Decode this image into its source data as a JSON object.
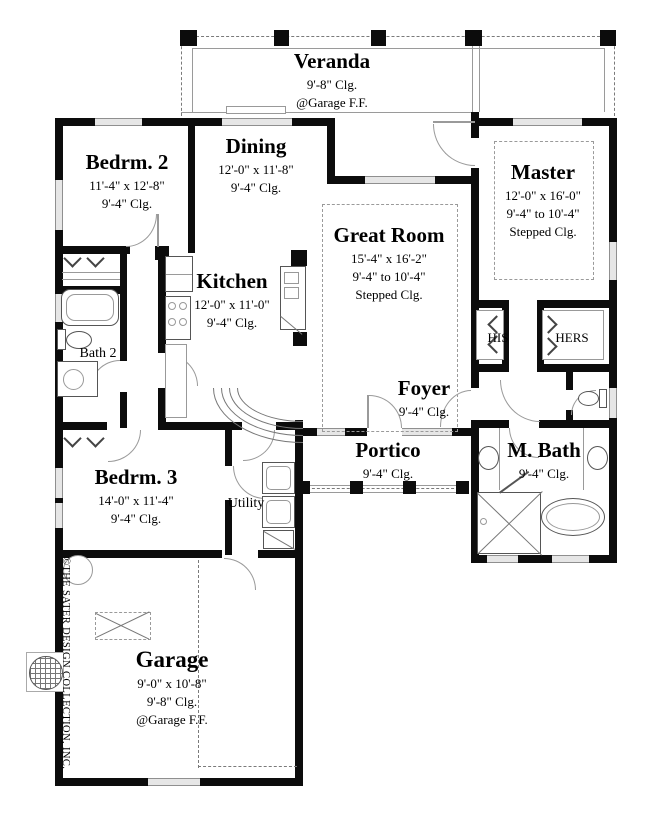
{
  "colors": {
    "wall": "#0c0c0c",
    "line": "#9a9a9a",
    "window_fill": "#e6e6e6"
  },
  "rooms": {
    "veranda": {
      "title": "Veranda",
      "clg": "9'-8\" Clg.",
      "note": "@Garage F.F."
    },
    "dining": {
      "title": "Dining",
      "dims": "12'-0\" x 11'-8\"",
      "clg": "9'-4\" Clg."
    },
    "bedroom2": {
      "title": "Bedrm. 2",
      "dims": "11'-4\" x 12'-8\"",
      "clg": "9'-4\" Clg."
    },
    "master": {
      "title": "Master",
      "dims": "12'-0\" x 16'-0\"",
      "clg": "9'-4\" to 10'-4\"",
      "clg2": "Stepped Clg."
    },
    "great_room": {
      "title": "Great Room",
      "dims": "15'-4\" x 16'-2\"",
      "clg": "9'-4\" to 10'-4\"",
      "clg2": "Stepped Clg."
    },
    "kitchen": {
      "title": "Kitchen",
      "dims": "12'-0\" x 11'-0\"",
      "clg": "9'-4\" Clg."
    },
    "bath2": {
      "title": "Bath 2"
    },
    "his": {
      "title": "HIS"
    },
    "hers": {
      "title": "HERS"
    },
    "foyer": {
      "title": "Foyer",
      "clg": "9'-4\" Clg."
    },
    "portico": {
      "title": "Portico",
      "clg": "9'-4\" Clg."
    },
    "mbath": {
      "title": "M. Bath",
      "clg": "9'-4\" Clg."
    },
    "bedroom3": {
      "title": "Bedrm. 3",
      "dims": "14'-0\" x 11'-4\"",
      "clg": "9'-4\" Clg."
    },
    "utility": {
      "title": "Utility"
    },
    "garage": {
      "title": "Garage",
      "dims": "9'-0\" x 10'-8\"",
      "clg": "9'-8\" Clg.",
      "note": "@Garage F.F."
    }
  },
  "branding": {
    "copyright": "©THE SATER DESIGN COLLECTION, INC."
  }
}
